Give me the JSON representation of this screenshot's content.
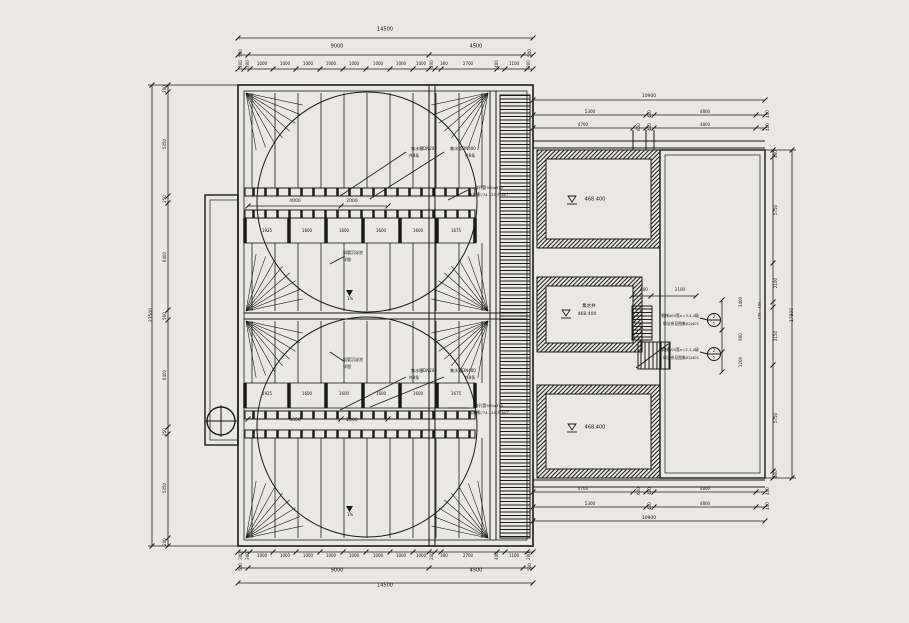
{
  "drawing": {
    "type": "plan-drawing",
    "background_color": "#e9e8e5",
    "line_color": "#1a1a1a",
    "tanks": {
      "upper_name": "斜管沉淀池",
      "upper_detail": "详图",
      "lower_name": "斜管沉淀池",
      "lower_detail": "详图"
    },
    "rooms": {
      "top_room_elevation": "468.400",
      "middle_room_name": "集水井",
      "middle_room_elevation": "468.400",
      "bottom_room_elevation": "468.400"
    }
  },
  "annotations": {
    "top_dims": [
      {
        "t": "14500",
        "x": 385,
        "y": 30,
        "s": 5
      },
      {
        "t": "9000",
        "x": 337,
        "y": 47,
        "s": 5
      },
      {
        "t": "4500",
        "x": 476,
        "y": 47,
        "s": 5
      },
      {
        "t": "500",
        "x": 241,
        "y": 53,
        "r": -90,
        "s": 4
      },
      {
        "t": "500",
        "x": 530,
        "y": 53,
        "r": -90,
        "s": 4
      },
      {
        "t": "300",
        "x": 241,
        "y": 64,
        "r": -90,
        "s": 4
      },
      {
        "t": "300",
        "x": 248,
        "y": 64,
        "r": -90,
        "s": 4
      },
      {
        "t": "1000",
        "x": 262,
        "y": 64,
        "s": 4
      },
      {
        "t": "1000",
        "x": 285,
        "y": 64,
        "s": 4
      },
      {
        "t": "1000",
        "x": 308,
        "y": 64,
        "s": 4
      },
      {
        "t": "1000",
        "x": 331,
        "y": 64,
        "s": 4
      },
      {
        "t": "1000",
        "x": 354,
        "y": 64,
        "s": 4
      },
      {
        "t": "1000",
        "x": 378,
        "y": 64,
        "s": 4
      },
      {
        "t": "1000",
        "x": 401,
        "y": 64,
        "s": 4
      },
      {
        "t": "1000",
        "x": 421,
        "y": 64,
        "s": 4
      },
      {
        "t": "200",
        "x": 432,
        "y": 64,
        "r": -90,
        "s": 4
      },
      {
        "t": "300",
        "x": 444,
        "y": 64,
        "s": 4
      },
      {
        "t": "2700",
        "x": 468,
        "y": 64,
        "s": 4
      },
      {
        "t": "400",
        "x": 497,
        "y": 64,
        "r": -90,
        "s": 4
      },
      {
        "t": "1100",
        "x": 514,
        "y": 64,
        "s": 4
      },
      {
        "t": "200",
        "x": 529,
        "y": 64,
        "r": -90,
        "s": 4
      }
    ],
    "bottom_dims": [
      {
        "t": "300",
        "x": 241,
        "y": 556,
        "r": -90,
        "s": 4
      },
      {
        "t": "300",
        "x": 248,
        "y": 556,
        "r": -90,
        "s": 4
      },
      {
        "t": "1000",
        "x": 262,
        "y": 556,
        "s": 4
      },
      {
        "t": "1000",
        "x": 285,
        "y": 556,
        "s": 4
      },
      {
        "t": "1000",
        "x": 308,
        "y": 556,
        "s": 4
      },
      {
        "t": "1000",
        "x": 331,
        "y": 556,
        "s": 4
      },
      {
        "t": "1000",
        "x": 354,
        "y": 556,
        "s": 4
      },
      {
        "t": "1000",
        "x": 378,
        "y": 556,
        "s": 4
      },
      {
        "t": "1000",
        "x": 401,
        "y": 556,
        "s": 4
      },
      {
        "t": "1000",
        "x": 421,
        "y": 556,
        "s": 4
      },
      {
        "t": "200",
        "x": 432,
        "y": 556,
        "r": -90,
        "s": 4
      },
      {
        "t": "300",
        "x": 444,
        "y": 556,
        "s": 4
      },
      {
        "t": "2700",
        "x": 468,
        "y": 556,
        "s": 4
      },
      {
        "t": "400",
        "x": 497,
        "y": 556,
        "r": -90,
        "s": 4
      },
      {
        "t": "1100",
        "x": 514,
        "y": 556,
        "s": 4
      },
      {
        "t": "200",
        "x": 529,
        "y": 556,
        "r": -90,
        "s": 4
      },
      {
        "t": "500",
        "x": 241,
        "y": 567,
        "r": -90,
        "s": 4
      },
      {
        "t": "9000",
        "x": 337,
        "y": 571,
        "s": 5
      },
      {
        "t": "4500",
        "x": 476,
        "y": 571,
        "s": 5
      },
      {
        "t": "500",
        "x": 530,
        "y": 567,
        "r": -90,
        "s": 4
      },
      {
        "t": "14500",
        "x": 385,
        "y": 586,
        "s": 5
      }
    ],
    "left_dims": [
      {
        "t": "23500",
        "x": 152,
        "y": 315,
        "r": -90,
        "s": 4.5
      },
      {
        "t": "200",
        "x": 165,
        "y": 89,
        "r": -90,
        "s": 4
      },
      {
        "t": "5350",
        "x": 165,
        "y": 144,
        "r": -90,
        "s": 4
      },
      {
        "t": "250",
        "x": 165,
        "y": 199,
        "r": -90,
        "s": 4
      },
      {
        "t": "6400",
        "x": 165,
        "y": 257,
        "r": -90,
        "s": 4
      },
      {
        "t": "500",
        "x": 165,
        "y": 316,
        "r": -90,
        "s": 4
      },
      {
        "t": "6400",
        "x": 165,
        "y": 375,
        "r": -90,
        "s": 4
      },
      {
        "t": "250",
        "x": 165,
        "y": 432,
        "r": -90,
        "s": 4
      },
      {
        "t": "5350",
        "x": 165,
        "y": 488,
        "r": -90,
        "s": 4
      },
      {
        "t": "200",
        "x": 165,
        "y": 542,
        "r": -90,
        "s": 4
      }
    ],
    "right_top_dims": [
      {
        "t": "10900",
        "x": 649,
        "y": 97,
        "s": 4.5
      },
      {
        "t": "5300",
        "x": 590,
        "y": 112,
        "s": 4
      },
      {
        "t": "400",
        "x": 650,
        "y": 114,
        "r": -90,
        "s": 4
      },
      {
        "t": "4800",
        "x": 705,
        "y": 112,
        "s": 4
      },
      {
        "t": "400",
        "x": 768,
        "y": 114,
        "r": -90,
        "s": 4
      },
      {
        "t": "4700",
        "x": 583,
        "y": 125,
        "s": 4
      },
      {
        "t": "600",
        "x": 639,
        "y": 127,
        "r": -90,
        "s": 4
      },
      {
        "t": "400",
        "x": 650,
        "y": 127,
        "r": -90,
        "s": 4
      },
      {
        "t": "4800",
        "x": 705,
        "y": 125,
        "s": 4
      },
      {
        "t": "400",
        "x": 768,
        "y": 127,
        "r": -90,
        "s": 4
      }
    ],
    "right_bottom_dims": [
      {
        "t": "4700",
        "x": 583,
        "y": 489,
        "s": 4
      },
      {
        "t": "600",
        "x": 639,
        "y": 491,
        "r": -90,
        "s": 4
      },
      {
        "t": "400",
        "x": 650,
        "y": 491,
        "r": -90,
        "s": 4
      },
      {
        "t": "4800",
        "x": 705,
        "y": 489,
        "s": 4
      },
      {
        "t": "400",
        "x": 768,
        "y": 491,
        "r": -90,
        "s": 4
      },
      {
        "t": "5300",
        "x": 590,
        "y": 504,
        "s": 4
      },
      {
        "t": "400",
        "x": 650,
        "y": 506,
        "r": -90,
        "s": 4
      },
      {
        "t": "4800",
        "x": 705,
        "y": 504,
        "s": 4
      },
      {
        "t": "400",
        "x": 768,
        "y": 506,
        "r": -90,
        "s": 4
      },
      {
        "t": "10900",
        "x": 649,
        "y": 519,
        "s": 4.5
      }
    ],
    "right_side_dims": [
      {
        "t": "400",
        "x": 776,
        "y": 154,
        "r": -90,
        "s": 4
      },
      {
        "t": "5750",
        "x": 776,
        "y": 210,
        "r": -90,
        "s": 4
      },
      {
        "t": "2100",
        "x": 776,
        "y": 283,
        "r": -90,
        "s": 4
      },
      {
        "t": "100",
        "x": 760,
        "y": 305,
        "r": -90,
        "s": 3.5
      },
      {
        "t": "150",
        "x": 760,
        "y": 316,
        "r": -90,
        "s": 3.5
      },
      {
        "t": "3150",
        "x": 776,
        "y": 336,
        "r": -90,
        "s": 4
      },
      {
        "t": "5750",
        "x": 776,
        "y": 418,
        "r": -90,
        "s": 4
      },
      {
        "t": "400",
        "x": 776,
        "y": 474,
        "r": -90,
        "s": 4
      },
      {
        "t": "17800",
        "x": 793,
        "y": 315,
        "r": -90,
        "s": 4.5
      },
      {
        "t": "3400",
        "x": 741,
        "y": 302,
        "r": -90,
        "s": 4
      },
      {
        "t": "900",
        "x": 741,
        "y": 337,
        "r": -90,
        "s": 4
      },
      {
        "t": "1200",
        "x": 741,
        "y": 362,
        "r": -90,
        "s": 4
      }
    ],
    "tank_upper": [
      {
        "t": "集水槽DN200",
        "x": 424,
        "y": 149,
        "s": 4
      },
      {
        "t": "共8条",
        "x": 414,
        "y": 156,
        "s": 4
      },
      {
        "t": "集水管DN400",
        "x": 463,
        "y": 149,
        "s": 4
      },
      {
        "t": "共8条",
        "x": 470,
        "y": 156,
        "s": 4
      },
      {
        "t": "4000",
        "x": 295,
        "y": 202,
        "s": 4.5
      },
      {
        "t": "2000",
        "x": 352,
        "y": 202,
        "s": 4.5
      },
      {
        "t": "1925",
        "x": 267,
        "y": 231,
        "s": 4
      },
      {
        "t": "1600",
        "x": 307,
        "y": 231,
        "s": 4
      },
      {
        "t": "1600",
        "x": 344,
        "y": 231,
        "s": 4
      },
      {
        "t": "1600",
        "x": 381,
        "y": 231,
        "s": 4
      },
      {
        "t": "1600",
        "x": 418,
        "y": 231,
        "s": 4
      },
      {
        "t": "1675",
        "x": 456,
        "y": 231,
        "s": 4
      },
      {
        "t": "穿孔管950x370",
        "x": 489,
        "y": 188,
        "s": 3.8
      },
      {
        "t": "集水槽▽74.120,共36个",
        "x": 489,
        "y": 195,
        "s": 3.8
      },
      {
        "t": "斜管沉淀池",
        "x": 353,
        "y": 253,
        "s": 4
      },
      {
        "t": "详图",
        "x": 347,
        "y": 260,
        "s": 4
      },
      {
        "t": "1%",
        "x": 350,
        "y": 299,
        "s": 4
      }
    ],
    "tank_lower": [
      {
        "t": "集水槽DN200",
        "x": 424,
        "y": 371,
        "s": 4
      },
      {
        "t": "共8条",
        "x": 414,
        "y": 378,
        "s": 4
      },
      {
        "t": "集水管DN400",
        "x": 463,
        "y": 371,
        "s": 4
      },
      {
        "t": "共8条",
        "x": 470,
        "y": 378,
        "s": 4
      },
      {
        "t": "1925",
        "x": 267,
        "y": 394,
        "s": 4
      },
      {
        "t": "1600",
        "x": 307,
        "y": 394,
        "s": 4
      },
      {
        "t": "1600",
        "x": 344,
        "y": 394,
        "s": 4
      },
      {
        "t": "1600",
        "x": 381,
        "y": 394,
        "s": 4
      },
      {
        "t": "1600",
        "x": 418,
        "y": 394,
        "s": 4
      },
      {
        "t": "1675",
        "x": 456,
        "y": 394,
        "s": 4
      },
      {
        "t": "穿孔管950x370",
        "x": 489,
        "y": 406,
        "s": 3.8
      },
      {
        "t": "集水槽▽74.120,共36个",
        "x": 489,
        "y": 413,
        "s": 3.8
      },
      {
        "t": "4000",
        "x": 295,
        "y": 421,
        "s": 4.5
      },
      {
        "t": "2000",
        "x": 352,
        "y": 421,
        "s": 4.5
      },
      {
        "t": "斜管沉淀池",
        "x": 353,
        "y": 360,
        "s": 4
      },
      {
        "t": "详图",
        "x": 347,
        "y": 367,
        "s": 4
      },
      {
        "t": "1%",
        "x": 350,
        "y": 515,
        "s": 4
      }
    ],
    "rooms": [
      {
        "t": "468.400",
        "x": 595,
        "y": 200,
        "s": 5
      },
      {
        "t": "集水井",
        "x": 589,
        "y": 307,
        "s": 4.5
      },
      {
        "t": "468.400",
        "x": 587,
        "y": 315,
        "s": 4.5
      },
      {
        "t": "468.400",
        "x": 595,
        "y": 428,
        "s": 5
      }
    ],
    "stairs": [
      {
        "t": "900",
        "x": 644,
        "y": 290,
        "s": 4
      },
      {
        "t": "2100",
        "x": 680,
        "y": 290,
        "s": 4
      },
      {
        "t": "钢梯400宽n=3.4,4级",
        "x": 680,
        "y": 316,
        "s": 3.8
      },
      {
        "t": "做法参见图集02J401",
        "x": 681,
        "y": 324,
        "s": 3.8
      },
      {
        "t": "钢梯400宽n=2.1,4级",
        "x": 680,
        "y": 350,
        "s": 3.8
      },
      {
        "t": "做法参见图集02J401",
        "x": 681,
        "y": 358,
        "s": 3.8
      },
      {
        "t": "2",
        "x": 714,
        "y": 317,
        "s": 4
      },
      {
        "t": "5",
        "x": 714,
        "y": 324,
        "s": 3.5
      },
      {
        "t": "2",
        "x": 714,
        "y": 351,
        "s": 4
      },
      {
        "t": "5",
        "x": 714,
        "y": 358,
        "s": 3.5
      }
    ]
  }
}
